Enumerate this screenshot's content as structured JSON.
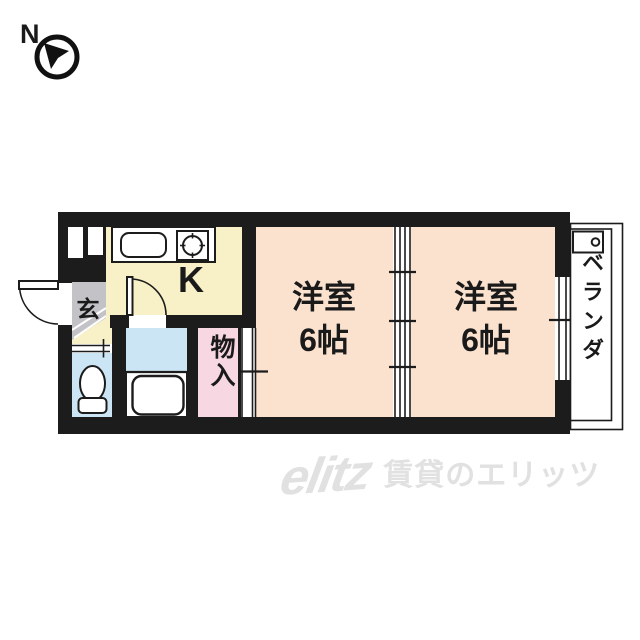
{
  "compass": {
    "north_label": "N"
  },
  "floor_plan": {
    "kitchen": {
      "label": "K"
    },
    "entrance": {
      "label": "玄"
    },
    "western_room_1": {
      "name": "洋室",
      "size": "6帖"
    },
    "western_room_2": {
      "name": "洋室",
      "size": "6帖"
    },
    "storage": {
      "label": "物入"
    },
    "veranda": {
      "label": "ベランダ"
    }
  },
  "watermark": {
    "logo": "elitz",
    "caption": "賃貸のエリッツ"
  },
  "colors": {
    "wall": "#1c1c1c",
    "kitchen_floor": "#f8f0c6",
    "room_floor": "#fbe2cf",
    "storage_floor": "#f7d7e2",
    "bath_floor": "#cbe5f4",
    "entrance_floor": "#c3c3c7",
    "watermark_gray": "#e1e1e1"
  }
}
